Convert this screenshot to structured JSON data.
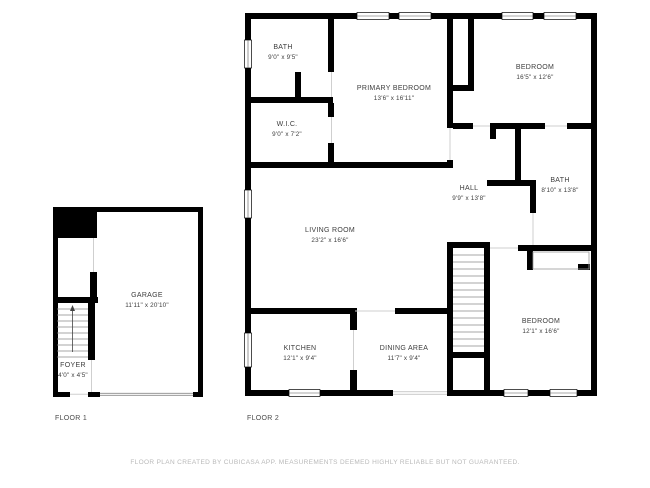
{
  "colors": {
    "wall": "#000000",
    "label_text": "#3d3d3d",
    "caption_text": "#4a4a4a",
    "disclaimer_text": "#b9b9b9"
  },
  "floor1": {
    "caption": "FLOOR 1",
    "rooms": [
      {
        "id": "garage",
        "name": "GARAGE",
        "dims": "11'11\" x 20'10\""
      },
      {
        "id": "foyer",
        "name": "FOYER",
        "dims": "4'0\" x 4'5\""
      }
    ]
  },
  "floor2": {
    "caption": "FLOOR 2",
    "rooms": [
      {
        "id": "bath-1",
        "name": "BATH",
        "dims": "9'0\" x 9'5\""
      },
      {
        "id": "wic",
        "name": "W.I.C.",
        "dims": "9'0\" x 7'2\""
      },
      {
        "id": "primary-bedroom",
        "name": "PRIMARY BEDROOM",
        "dims": "13'6\" x 16'11\""
      },
      {
        "id": "bedroom-1",
        "name": "BEDROOM",
        "dims": "16'5\" x 12'6\""
      },
      {
        "id": "hall",
        "name": "HALL",
        "dims": "9'9\" x 13'8\""
      },
      {
        "id": "bath-2",
        "name": "BATH",
        "dims": "8'10\" x 13'8\""
      },
      {
        "id": "living-room",
        "name": "LIVING ROOM",
        "dims": "23'2\" x 16'6\""
      },
      {
        "id": "kitchen",
        "name": "KITCHEN",
        "dims": "12'1\" x 9'4\""
      },
      {
        "id": "dining-area",
        "name": "DINING AREA",
        "dims": "11'7\" x 9'4\""
      },
      {
        "id": "bedroom-2",
        "name": "BEDROOM",
        "dims": "12'1\" x 16'6\""
      }
    ]
  },
  "footer": {
    "disclaimer": "FLOOR PLAN CREATED BY CUBICASA APP. MEASUREMENTS DEEMED HIGHLY RELIABLE BUT NOT GUARANTEED."
  }
}
